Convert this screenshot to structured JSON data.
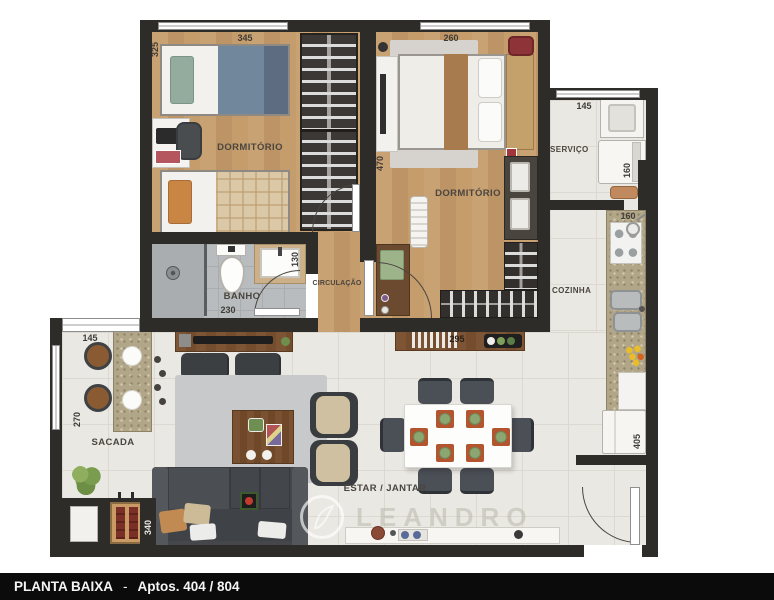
{
  "title_bar": {
    "name": "PLANTA BAIXA",
    "dash": "-",
    "apartments": "Aptos. 404 / 804"
  },
  "watermark": {
    "text": "LEANDRO"
  },
  "rooms": {
    "dormitorio_1": {
      "label": "DORMITÓRIO",
      "width": "345",
      "height": "325"
    },
    "dormitorio_2": {
      "label": "DORMITÓRIO",
      "width": "260",
      "height": "470"
    },
    "banho": {
      "label": "BANHO",
      "width": "230",
      "height": "130"
    },
    "circulacao": {
      "label": "CIRCULAÇÃO"
    },
    "servico": {
      "label": "SERVIÇO",
      "width": "145",
      "height": "160"
    },
    "cozinha": {
      "label": "COZINHA",
      "width": "160",
      "height": "405"
    },
    "sacada": {
      "label": "SACADA",
      "width": "145",
      "height": "270"
    },
    "estar_jantar": {
      "label": "ESTAR / JANTAR",
      "width": "795",
      "height": "340",
      "sideboard_width": "295"
    }
  },
  "colors": {
    "wall": "#2e2c29",
    "wood_floor": "#c49a6c",
    "tile_floor": "#eae8e2",
    "bath_floor": "#b9bcbe",
    "granite": "#b2a689",
    "sofa": "#45474b",
    "furniture_wood": "#7d5535",
    "placemat": "#b3552f",
    "plate": "#8ba671"
  }
}
